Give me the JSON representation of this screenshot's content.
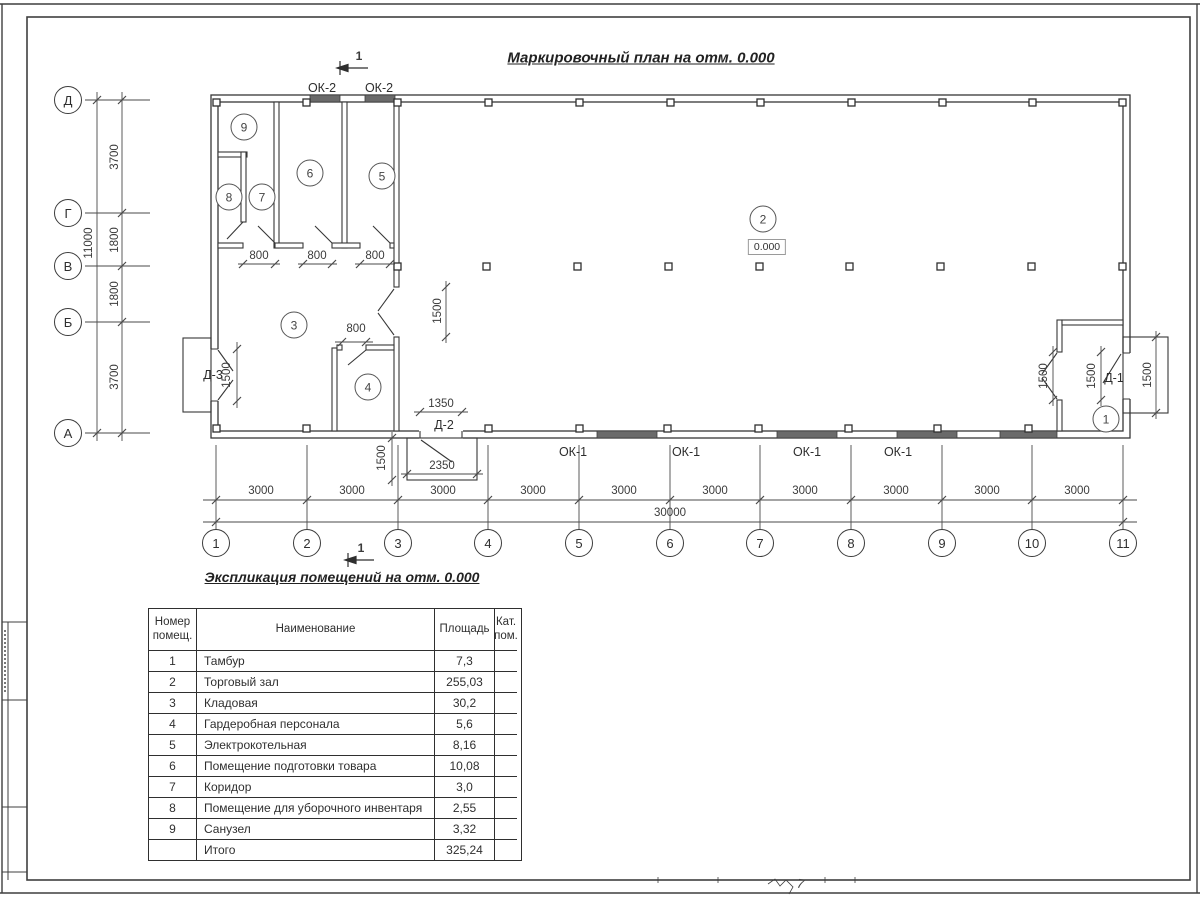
{
  "page": {
    "title": "Маркировочный план на отм. 0.000",
    "schedule_title": "Экспликация помещений на отм. 0.000",
    "footer_mark": "7"
  },
  "plan": {
    "section_mark": "1",
    "elevation_mark": "0.000",
    "axis_letters": [
      "Д",
      "Г",
      "В",
      "Б",
      "А"
    ],
    "axis_numbers": [
      "1",
      "2",
      "3",
      "4",
      "5",
      "6",
      "7",
      "8",
      "9",
      "10",
      "11"
    ],
    "room_numbers": [
      "1",
      "2",
      "3",
      "4",
      "5",
      "6",
      "7",
      "8",
      "9"
    ],
    "dims": {
      "v_segments": [
        "3700",
        "1800",
        "1800",
        "3700"
      ],
      "v_total": "11000",
      "h_segment": "3000",
      "h_total": "30000",
      "door_800": "800",
      "d_1500": "1500",
      "d_1350": "1350",
      "d_2350": "2350"
    },
    "marks": {
      "ok1": "ОК-1",
      "ok2": "ОК-2",
      "d1": "Д-1",
      "d2": "Д-2",
      "d3": "Д-3"
    }
  },
  "schedule": {
    "headers": {
      "num": "Номер помещ.",
      "name": "Наименование",
      "area": "Площадь",
      "cat": "Кат. пом."
    },
    "rows": [
      {
        "num": "1",
        "name": "Тамбур",
        "area": "7,3",
        "cat": ""
      },
      {
        "num": "2",
        "name": "Торговый зал",
        "area": "255,03",
        "cat": ""
      },
      {
        "num": "3",
        "name": "Кладовая",
        "area": "30,2",
        "cat": ""
      },
      {
        "num": "4",
        "name": "Гардеробная персонала",
        "area": "5,6",
        "cat": ""
      },
      {
        "num": "5",
        "name": "Электрокотельная",
        "area": "8,16",
        "cat": ""
      },
      {
        "num": "6",
        "name": "Помещение подготовки товара",
        "area": "10,08",
        "cat": ""
      },
      {
        "num": "7",
        "name": "Коридор",
        "area": "3,0",
        "cat": ""
      },
      {
        "num": "8",
        "name": "Помещение для уборочного инвентаря",
        "area": "2,55",
        "cat": ""
      },
      {
        "num": "9",
        "name": "Санузел",
        "area": "3,32",
        "cat": ""
      },
      {
        "num": "",
        "name": "Итого",
        "area": "325,24",
        "cat": ""
      }
    ]
  },
  "colors": {
    "line": "#3c3c3c",
    "window_fill": "#6a6a6a",
    "background": "#ffffff"
  }
}
